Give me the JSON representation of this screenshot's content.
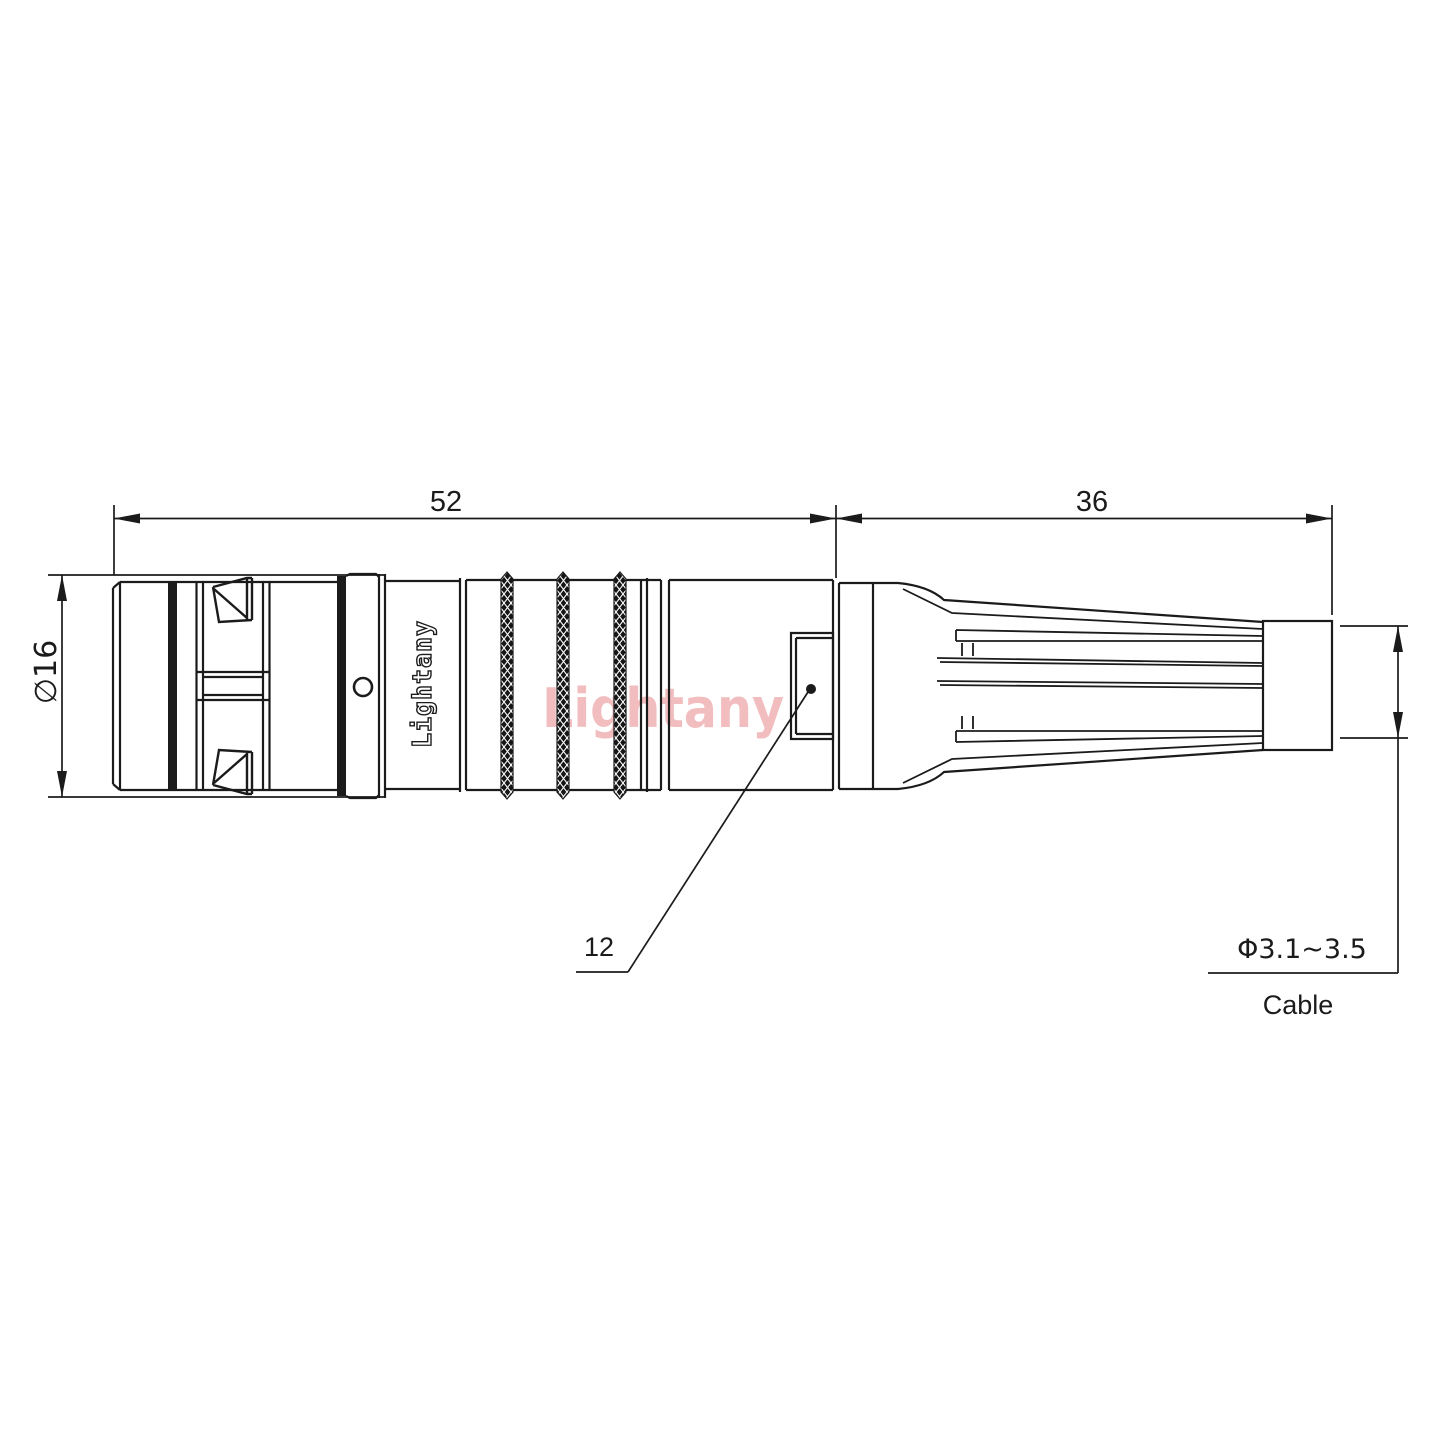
{
  "drawing": {
    "background": "#ffffff",
    "line_color": "#1b1b1b",
    "watermark_color": "#f2bdbf",
    "brand_text": "Lightany",
    "watermark_text": "Lightany",
    "dimensions": {
      "front_length": "52",
      "boot_length": "36",
      "diameter": "∅16",
      "mid_ref": "12",
      "cable_range": "Φ3.1~3.5",
      "cable_label": "Cable"
    }
  }
}
